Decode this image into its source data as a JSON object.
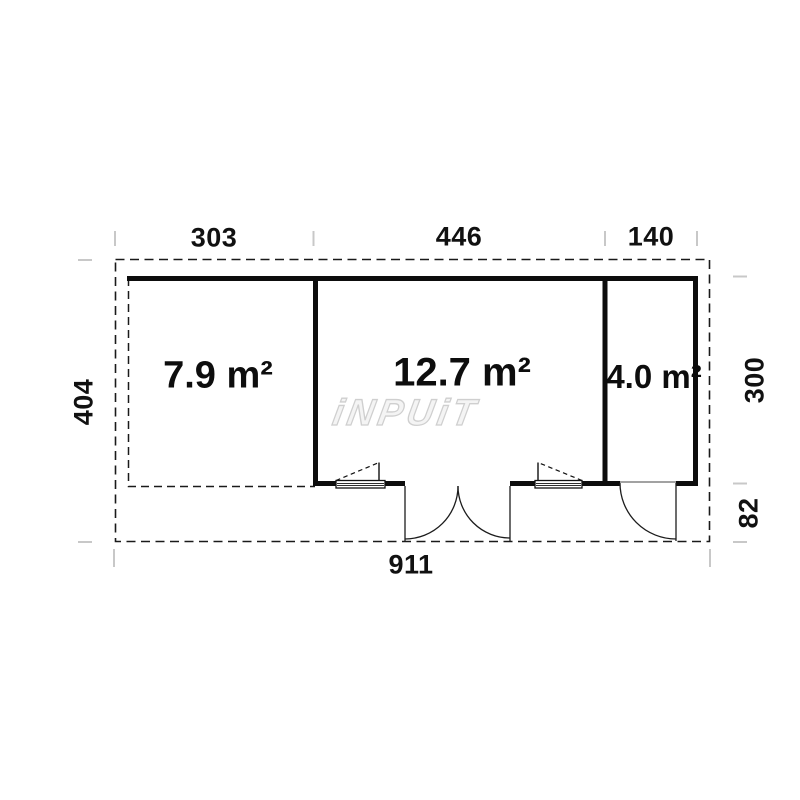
{
  "watermark": {
    "text": "iNPUiT"
  },
  "rooms": [
    {
      "id": "terrace",
      "area_label": "7.9 m²"
    },
    {
      "id": "main-room",
      "area_label": "12.7 m²"
    },
    {
      "id": "side-room",
      "area_label": "4.0 m²"
    }
  ],
  "dimensions_cm": {
    "top_terrace": "303",
    "top_main": "446",
    "top_side": "140",
    "left_depth": "404",
    "right_height": "300",
    "right_overhang": "82",
    "bottom_width": "911"
  },
  "colors": {
    "line": "#111111",
    "dashed_line": "#1a1a1a",
    "tick": "#c8c8c8",
    "watermark_outline": "#cfcfcf",
    "background": "#ffffff"
  }
}
